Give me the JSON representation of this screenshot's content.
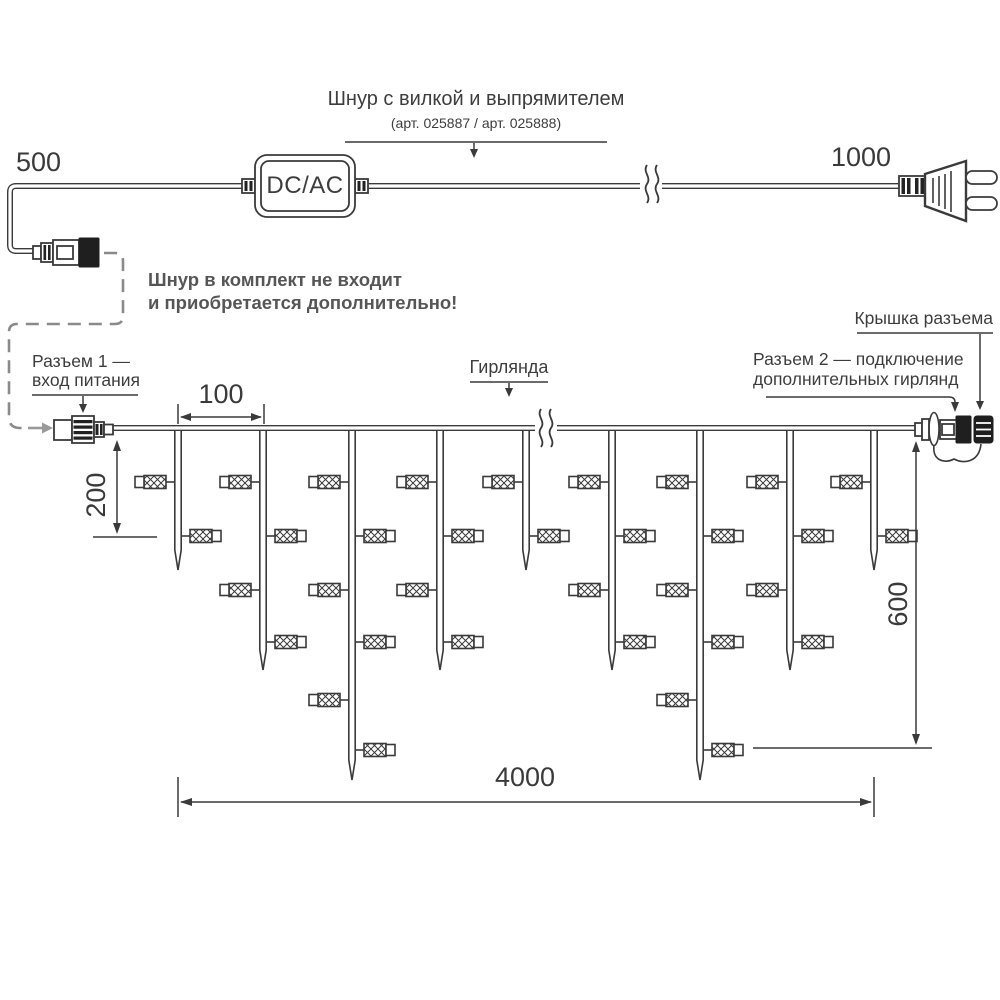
{
  "power_cord": {
    "cord_label": "Шнур с вилкой и выпрямителем",
    "cord_articles": "(арт. 025887 / арт. 025888)",
    "adapter_label": "DC/AC",
    "dim_cord_left": "500",
    "dim_cord_right": "1000",
    "note_line1": "Шнур в комплект не входит",
    "note_line2": "и приобретается дополнительно!"
  },
  "garland": {
    "connector1_label_line1": "Разъем 1 —",
    "connector1_label_line2": "вход питания",
    "garland_label": "Гирлянда",
    "connector2_label_line1": "Разъем 2 — подключение",
    "connector2_label_line2": "дополнительных гирлянд",
    "cap_label": "Крышка разъема",
    "dim_drop_spacing": "100",
    "dim_first_drop": "200",
    "dim_total_height": "600",
    "dim_total_length": "4000",
    "drop_types": {
      "short": {
        "tip_y": 570,
        "bulb_y": [
          482,
          536
        ]
      },
      "medium": {
        "tip_y": 670,
        "bulb_y": [
          482,
          536,
          590,
          642
        ]
      },
      "long": {
        "tip_y": 780,
        "bulb_y": [
          482,
          536,
          590,
          642,
          700,
          750
        ]
      }
    },
    "drops": [
      {
        "x": 178,
        "length": "short"
      },
      {
        "x": 263,
        "length": "medium"
      },
      {
        "x": 352,
        "length": "long"
      },
      {
        "x": 440,
        "length": "medium"
      },
      {
        "x": 526,
        "length": "short"
      },
      {
        "x": 612,
        "length": "medium"
      },
      {
        "x": 700,
        "length": "long"
      },
      {
        "x": 790,
        "length": "medium"
      },
      {
        "x": 874,
        "length": "short"
      }
    ]
  },
  "colors": {
    "line": "#3a3a3a",
    "text": "#3d3d3d",
    "note_text": "#565656",
    "dash_leader": "#8a8a8a"
  }
}
